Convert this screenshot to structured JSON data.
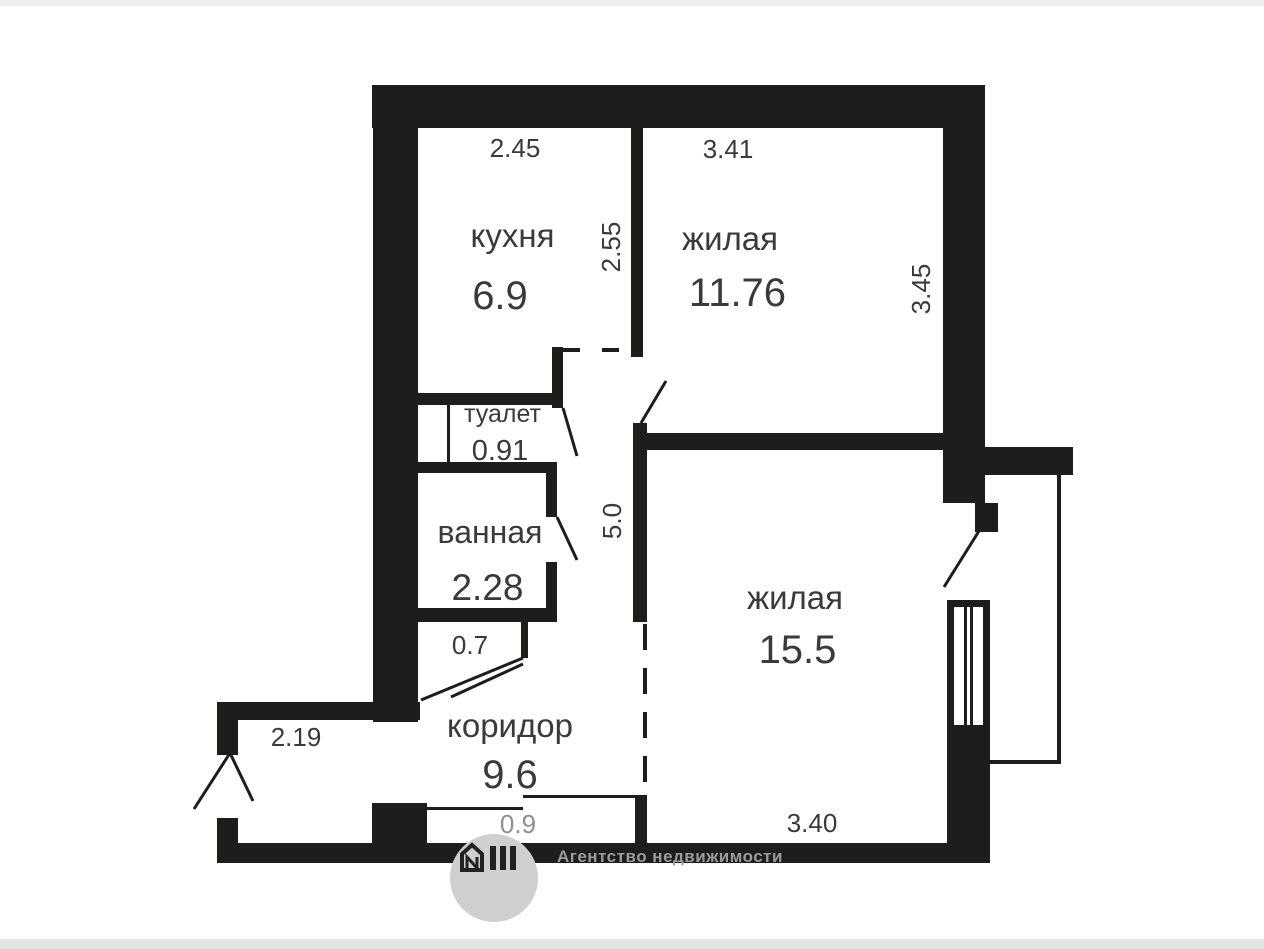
{
  "plan": {
    "rooms": {
      "kitchen": {
        "name": "кухня",
        "area": "6.9"
      },
      "living1": {
        "name": "жилая",
        "area": "11.76"
      },
      "toilet": {
        "name": "туалет",
        "area": "0.91"
      },
      "bath": {
        "name": "ванная",
        "area": "2.28"
      },
      "corridor": {
        "name": "коридор",
        "area": "9.6"
      },
      "living2": {
        "name": "жилая",
        "area": "15.5"
      }
    },
    "dimensions": {
      "kitchen_width": "2.45",
      "kitchen_depth": "2.55",
      "living1_width": "3.41",
      "living1_depth": "3.45",
      "corridor_length": "5.0",
      "bath_passage": "0.7",
      "entry_width": "2.19",
      "threshold": "0.9",
      "living2_width": "3.40"
    }
  },
  "watermark": {
    "agency": "Агентство недвижимости"
  },
  "colors": {
    "wall": "#1d1d1b",
    "label_text": "#3a3a3a",
    "muted_dimension": "#8f8f8f",
    "watermark_text": "#9c9c9c",
    "logo_circle": "#cfcfcf"
  }
}
